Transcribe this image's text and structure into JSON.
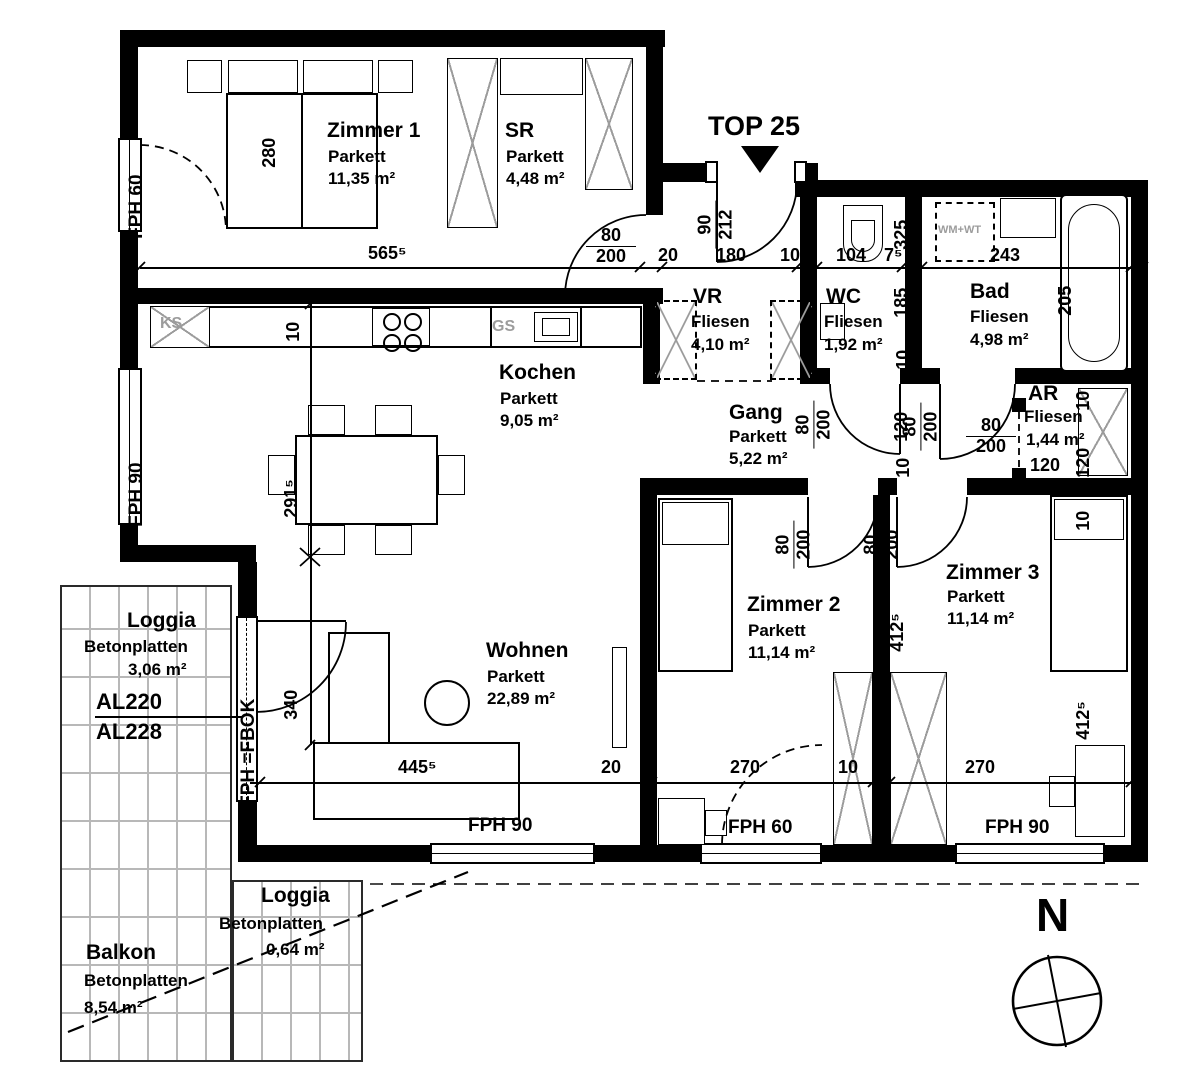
{
  "palette": {
    "ink": "#000000",
    "muted_gray": "#9c9c9c",
    "tile_line": "#b8b8b8"
  },
  "plan": {
    "unit_label": "TOP 25",
    "north": "N"
  },
  "rooms": [
    {
      "name": "Zimmer 1",
      "floor": "Parkett",
      "area": "11,35 m²"
    },
    {
      "name": "SR",
      "floor": "Parkett",
      "area": "4,48 m²"
    },
    {
      "name": "VR",
      "floor": "Fliesen",
      "area": "4,10 m²"
    },
    {
      "name": "WC",
      "floor": "Fliesen",
      "area": "1,92 m²"
    },
    {
      "name": "Bad",
      "floor": "Fliesen",
      "area": "4,98 m²"
    },
    {
      "name": "AR",
      "floor": "Fliesen",
      "area": "1,44 m²"
    },
    {
      "name": "Kochen",
      "floor": "Parkett",
      "area": "9,05 m²"
    },
    {
      "name": "Gang",
      "floor": "Parkett",
      "area": "5,22 m²"
    },
    {
      "name": "Wohnen",
      "floor": "Parkett",
      "area": "22,89 m²"
    },
    {
      "name": "Zimmer 2",
      "floor": "Parkett",
      "area": "11,14 m²"
    },
    {
      "name": "Zimmer 3",
      "floor": "Parkett",
      "area": "11,14 m²"
    },
    {
      "name": "Loggia",
      "floor": "Betonplatten",
      "area": "3,06 m²"
    },
    {
      "name": "Balkon",
      "floor": "Betonplatten",
      "area": "8,54 m²"
    },
    {
      "name": "Loggia",
      "floor": "Betonplatten",
      "area": "0,64 m²"
    }
  ],
  "doors": {
    "standard_w": "80",
    "standard_h": "200",
    "entrance_w": "90",
    "entrance_h": "212"
  },
  "dims": {
    "zimmer1_width": "565⁵",
    "zimmer1_bed": "280",
    "entry_1": "20",
    "entry_2": "180",
    "entry_3": "10",
    "wc_width": "104",
    "wc_extra": "7⁵",
    "bad_width": "243",
    "bad_left_1": "325",
    "bad_left_2": "185",
    "bad_left_3": "10",
    "tub_length": "205",
    "counter_10": "10",
    "kitchen_depth": "291⁵",
    "wohnen_left": "340",
    "sofa_width": "445⁵",
    "wohnen_right": "20",
    "z2_width": "270",
    "z23_wall": "10",
    "z3_width": "270",
    "z2_height": "412⁵",
    "z3_height": "412⁵",
    "z3_top": "10",
    "gang_120": "120",
    "gang_10": "10",
    "ar_door": "120",
    "ar_right_10": "10",
    "ar_right_120": "120"
  },
  "labels": {
    "fph60": "FPH 60",
    "fph90": "FPH 90",
    "fph_fbok": "FPH =FBOK",
    "al_top": "AL220",
    "al_bottom": "AL228",
    "fridge": "KS",
    "dishwasher": "GS",
    "washer": "WM+WT"
  }
}
